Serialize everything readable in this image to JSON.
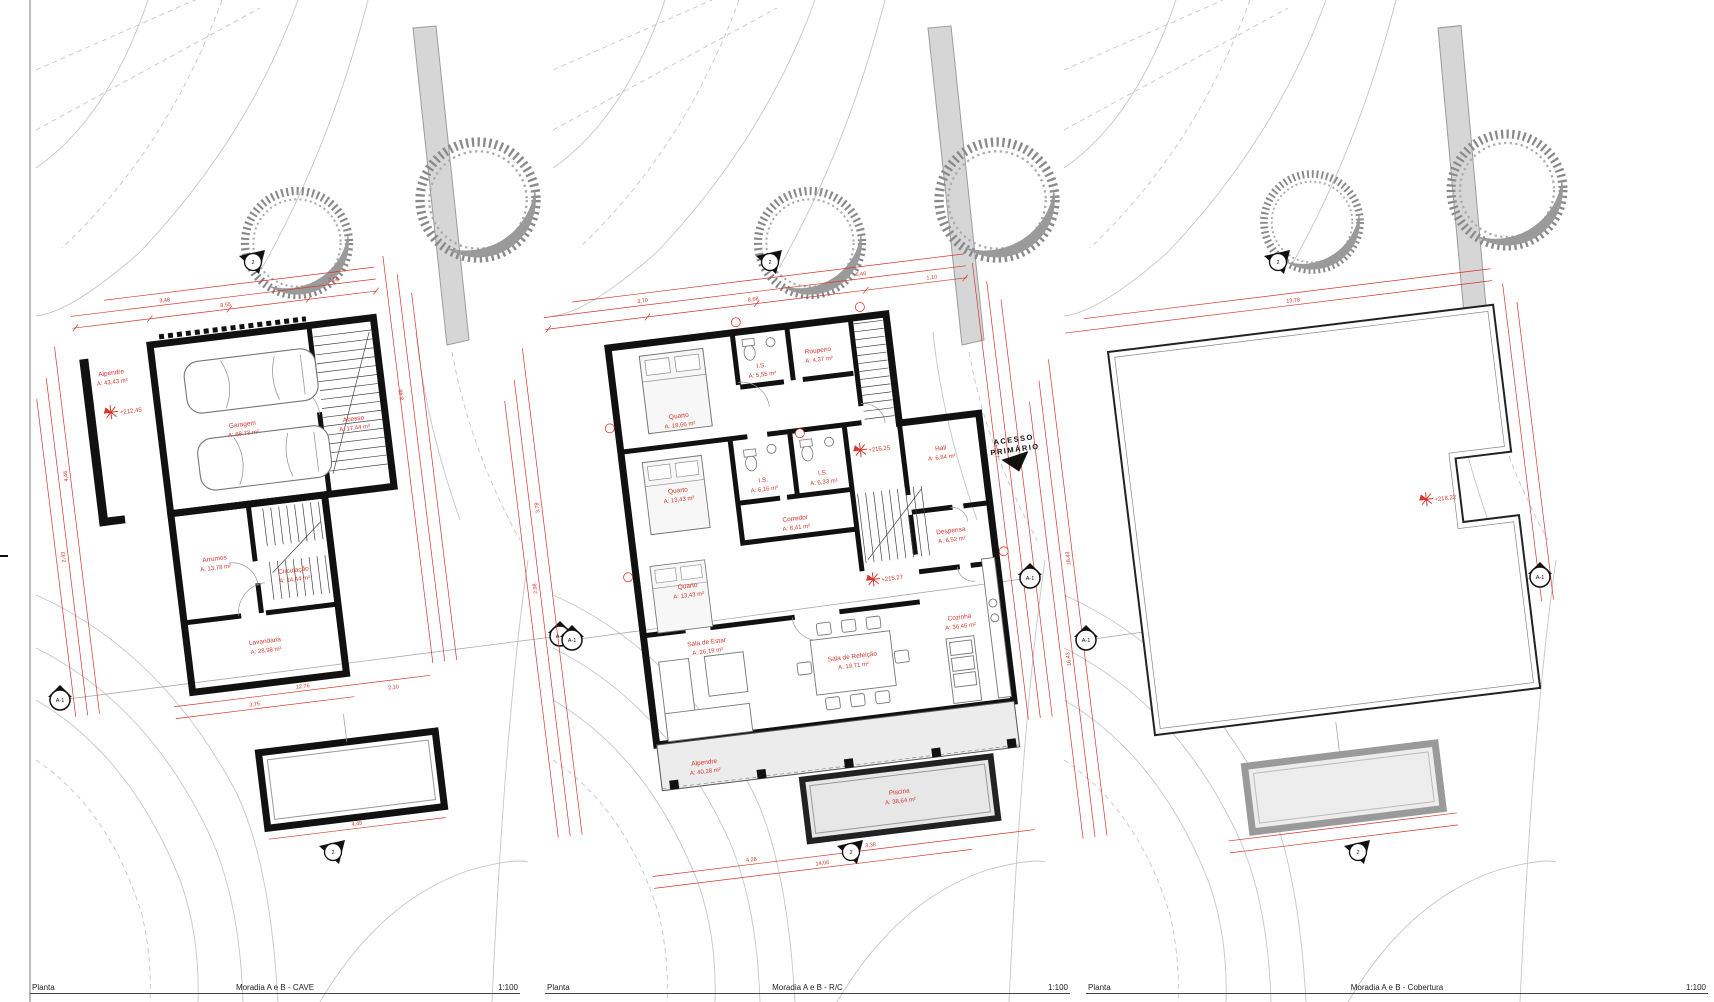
{
  "title_blocks": [
    {
      "label": "Planta",
      "name": "Moradia A e B - CAVE",
      "scale": "1:100"
    },
    {
      "label": "Planta",
      "name": "Moradia A e B - R/C",
      "scale": "1:100"
    },
    {
      "label": "Planta",
      "name": "Moradia A e B - Cobertura",
      "scale": "1:100"
    }
  ],
  "meta": {
    "section_marker": "A-1",
    "view_marker": "2"
  },
  "colors": {
    "dimension_red": "#d4382e",
    "wall_black": "#111111",
    "room_fill": "#eaeaea",
    "tree_gray": "#8f8f8f",
    "road_gray": "#d6d6d6",
    "contour_gray": "#c6c6c6"
  },
  "panels": {
    "cave": {
      "elevation": "+212,45",
      "rooms": {
        "alpendre": {
          "name": "Alpendre",
          "area": "A: 43,43 m²"
        },
        "garagem": {
          "name": "Garagem",
          "area": "A: 68,73 m²"
        },
        "acesso": {
          "name": "Acesso",
          "area": "A: 17,44 m²"
        },
        "arrumos": {
          "name": "Arrumos",
          "area": "A: 13,78 m²"
        },
        "circulacao": {
          "name": "Circulação",
          "area": "A: 14,44 m²"
        },
        "lavandaria": {
          "name": "Lavandaria",
          "area": "A: 28,98 m²"
        }
      },
      "dims": [
        "8,55",
        "2,68",
        "3,48",
        "4,46",
        "2,43",
        "8,46",
        "12,76",
        "3,75",
        "2,10",
        "4,45"
      ]
    },
    "rc": {
      "elevation_entry": "+215,25",
      "elevation_living": "+215,27",
      "access": {
        "line1": "ACESSO",
        "line2": "PRIMÁRIO"
      },
      "rooms": {
        "quarto1": {
          "name": "Quarto",
          "area": "A: 18,66 m²"
        },
        "is1": {
          "name": "I.S.",
          "area": "A: 5,55 m²"
        },
        "roupeiro": {
          "name": "Roupeiro",
          "area": "A: 4,37 m²"
        },
        "quarto2": {
          "name": "Quarto",
          "area": "A: 13,43 m²"
        },
        "is2": {
          "name": "I.S.",
          "area": "A: 6,16 m²"
        },
        "is3": {
          "name": "I.S.",
          "area": "A: 6,33 m²"
        },
        "quarto3": {
          "name": "Quarto",
          "area": "A: 13,43 m²"
        },
        "corredor": {
          "name": "Corredor",
          "area": "A: 8,41 m²"
        },
        "hall": {
          "name": "Hall",
          "area": "A: 6,84 m²"
        },
        "despensa": {
          "name": "Despensa",
          "area": "A: 6,52 m²"
        },
        "cozinha": {
          "name": "Cozinha",
          "area": "A: 36,46 m²"
        },
        "sala_estar": {
          "name": "Sala de Estar",
          "area": "A: 26,19 m²"
        },
        "sala_refeicao": {
          "name": "Sala de Refeição",
          "area": "A: 19,71 m²"
        },
        "alpendre": {
          "name": "Alpendre",
          "area": "A: 40,28 m²"
        },
        "piscina": {
          "name": "Piscina",
          "area": "A: 38,64 m²"
        }
      },
      "dims": [
        "8,68",
        "3,70",
        "6,46",
        "1,10",
        "3,78",
        "2,98",
        "13,04",
        "4,28",
        "3,38",
        "14,06"
      ]
    },
    "cobertura": {
      "elevation": "+218,22",
      "dims": [
        "13,78",
        "18,43",
        "1,10",
        "16,43"
      ]
    }
  }
}
